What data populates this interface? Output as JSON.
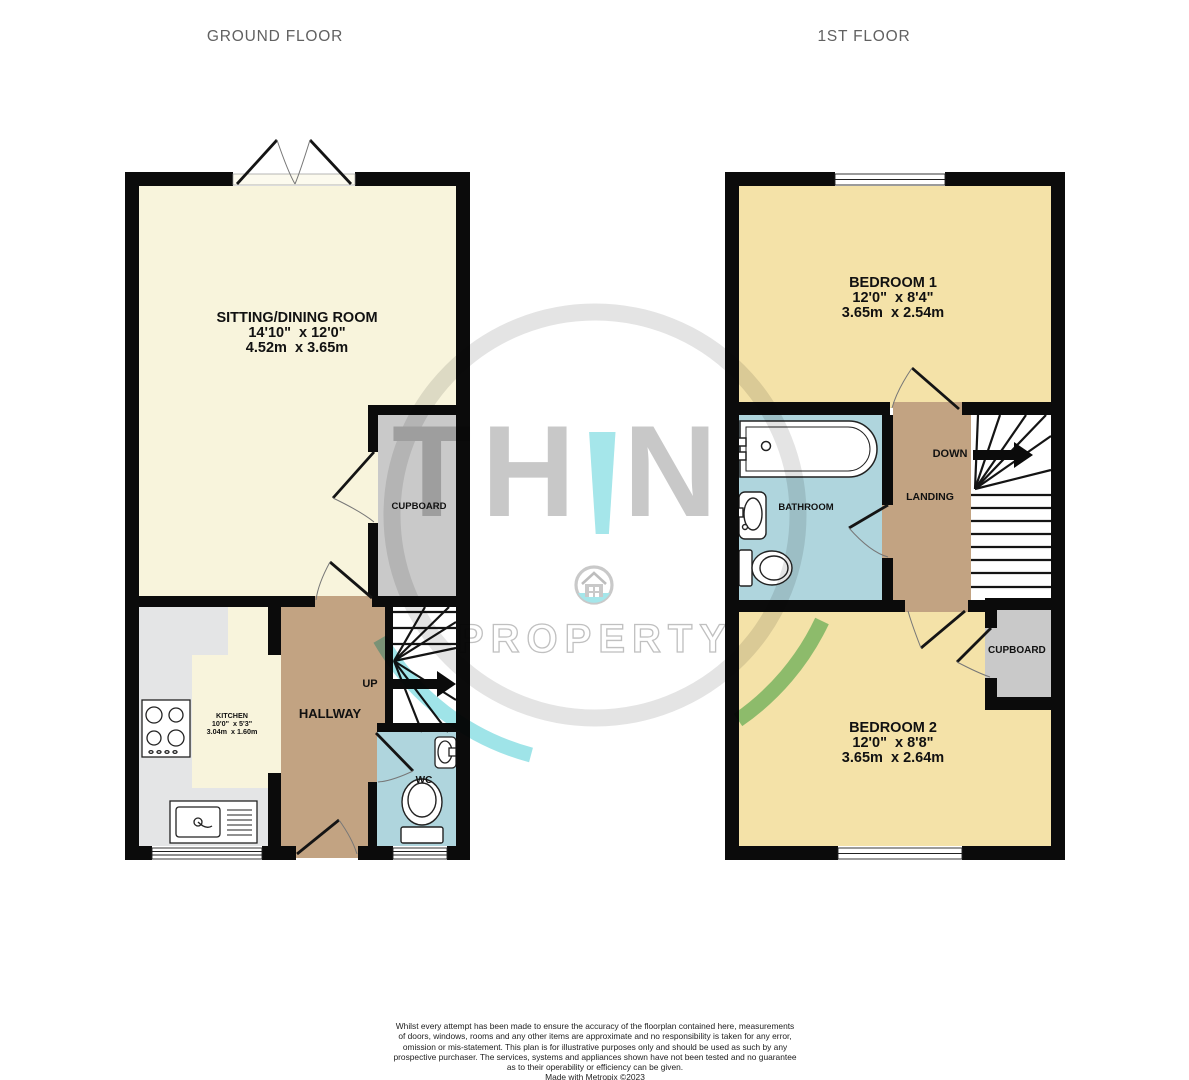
{
  "ground_floor": {
    "label": "GROUND FLOOR",
    "rooms": {
      "sitting_dining": {
        "name": "SITTING/DINING ROOM",
        "imperial": "14'10\"  x 12'0\"",
        "metric": "4.52m  x 3.65m"
      },
      "kitchen": {
        "name": "KITCHEN",
        "imperial": "10'0\"  x 5'3\"",
        "metric": "3.04m  x 1.60m"
      },
      "hallway": {
        "name": "HALLWAY"
      },
      "cupboard": {
        "name": "CUPBOARD"
      },
      "wc": {
        "name": "WC"
      },
      "stairs": {
        "direction": "UP"
      }
    }
  },
  "first_floor": {
    "label": "1ST FLOOR",
    "rooms": {
      "bedroom1": {
        "name": "BEDROOM 1",
        "imperial": "12'0\"  x 8'4\"",
        "metric": "3.65m  x 2.54m"
      },
      "bedroom2": {
        "name": "BEDROOM 2",
        "imperial": "12'0\"  x 8'8\"",
        "metric": "3.65m  x 2.64m"
      },
      "bathroom": {
        "name": "BATHROOM"
      },
      "landing": {
        "name": "LANDING"
      },
      "cupboard": {
        "name": "CUPBOARD"
      },
      "stairs": {
        "direction": "DOWN"
      }
    }
  },
  "watermark": {
    "brand_pre": "TH",
    "brand_accent": "!",
    "brand_post": "NK",
    "brand_bottom": "PROPERTY"
  },
  "footer": {
    "lines": [
      "Whilst every attempt has been made to ensure the accuracy of the floorplan contained here, measurements",
      "of doors, windows, rooms and any other items are approximate and no responsibility is taken for any error,",
      "omission or mis-statement. This plan is for illustrative purposes only and should be used as such by any",
      "prospective purchaser. The services, systems and appliances shown have not been tested and no guarantee",
      "as to their operability or efficiency can be given.",
      "Made with Metropix ©2023"
    ]
  },
  "colors": {
    "wall": "#0b0b0b",
    "sitting_room_fill": "#F8F4DC",
    "bedroom_fill": "#F4E2A8",
    "hallway_fill": "#C2A382",
    "bathroom_fill": "#AFD5DD",
    "cupboard_fill": "#C9C9C9",
    "kitchen_counter_fill": "#E4E5E6",
    "brand_gray": "#C8C8C8",
    "brand_cyan": "#A5E6EA",
    "ring_gray": "#E4E4E4",
    "arc_cyan": "#9FE4E8",
    "arc_green": "#93D3A2"
  }
}
